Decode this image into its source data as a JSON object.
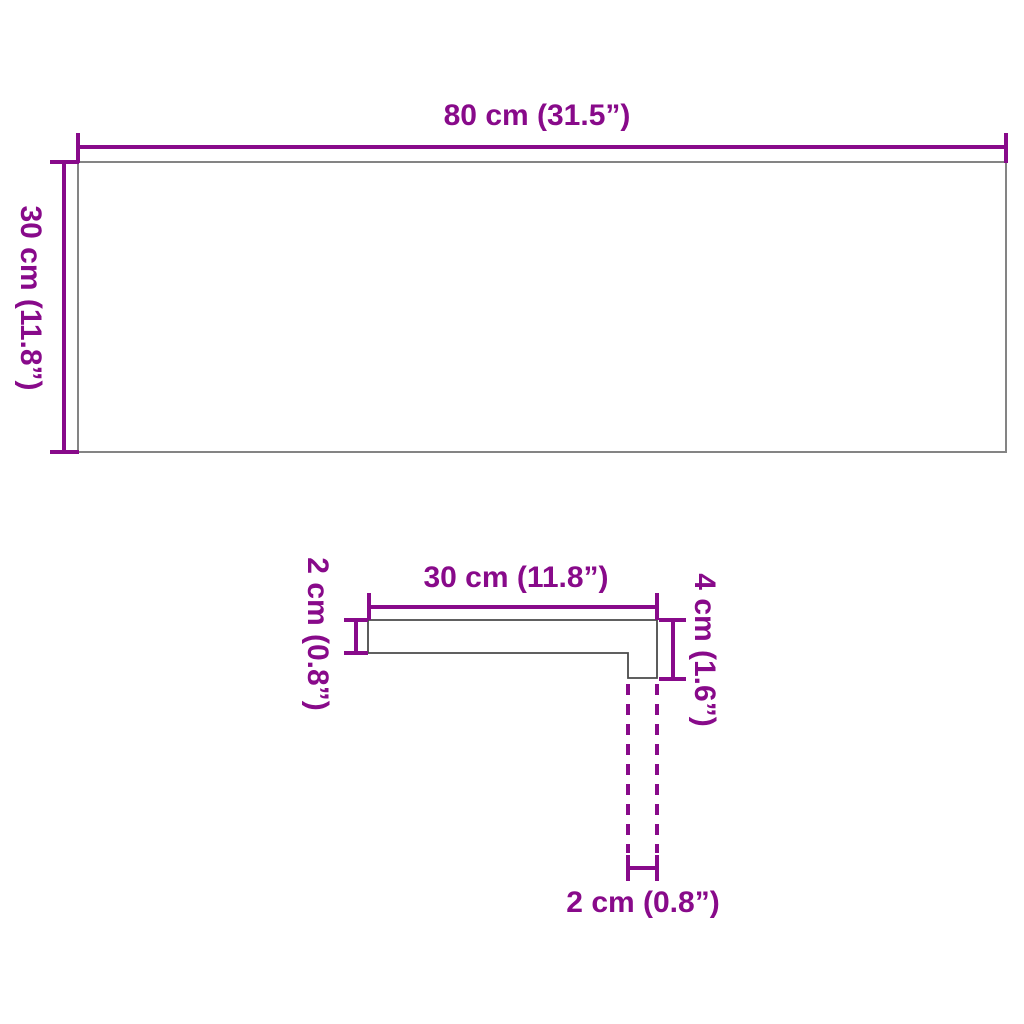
{
  "colors": {
    "dimension": "#880A8A",
    "outline": "#848484",
    "profile_outline": "#4A4A4A",
    "background": "#FFFFFF"
  },
  "labels": {
    "top_width": "80 cm (31.5”)",
    "top_height": "30 cm (11.8”)",
    "profile_width": "30 cm (11.8”)",
    "profile_thickness": "2 cm (0.8”)",
    "profile_height": "4 cm (1.6”)",
    "profile_step_width": "2 cm (0.8”)"
  }
}
